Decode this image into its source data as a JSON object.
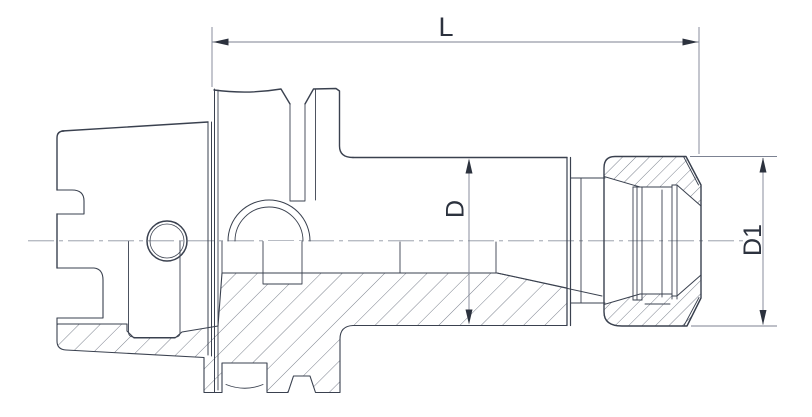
{
  "drawing": {
    "kind": "technical-section-drawing",
    "dimensions": {
      "length": {
        "label": "L"
      },
      "body_diameter": {
        "label": "D"
      },
      "nut_diameter": {
        "label": "D1"
      }
    },
    "colors": {
      "outline": "#3a414f",
      "hatch": "#5a6170",
      "dimension": "#7c8292",
      "centerline": "#8d93a0",
      "text": "#2c323e",
      "background": "#ffffff"
    }
  }
}
